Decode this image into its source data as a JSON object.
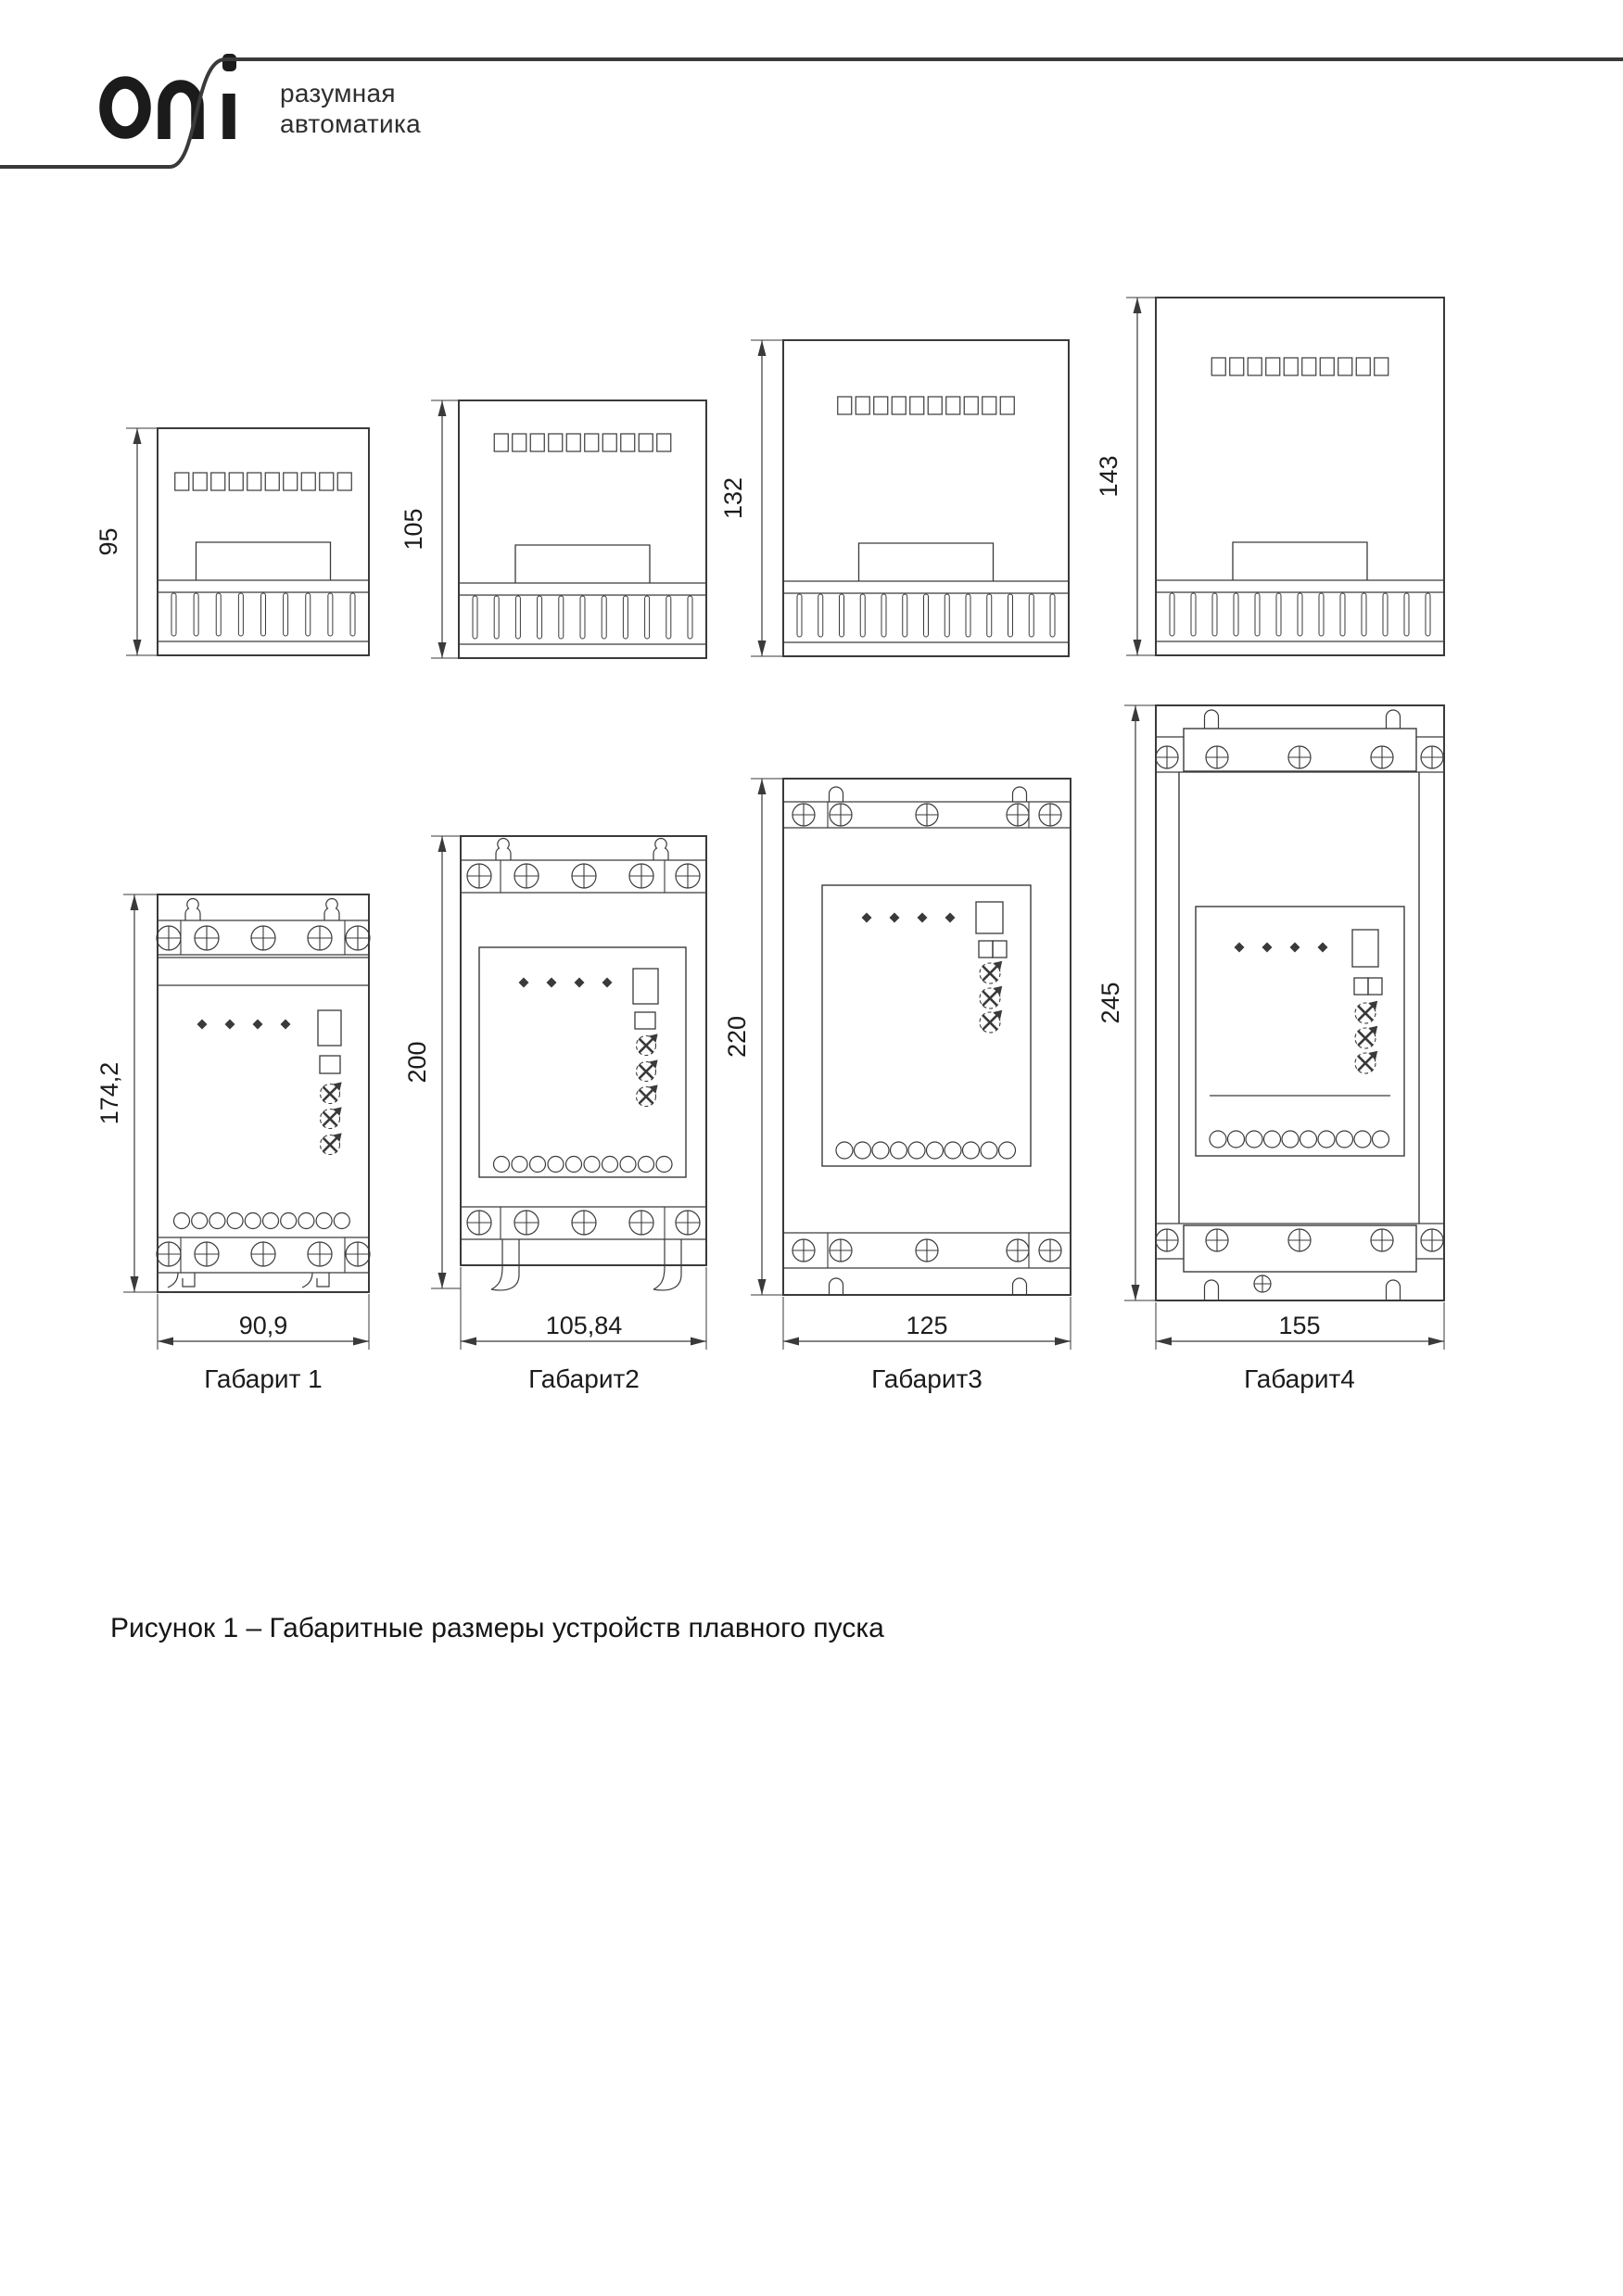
{
  "header": {
    "logo_text": "oni",
    "tagline": [
      "разумная",
      "автоматика"
    ]
  },
  "figure": {
    "caption": "Рисунок 1 – Габаритные размеры устройств плавного пуска",
    "side_views": [
      {
        "height_mm": "95"
      },
      {
        "height_mm": "105"
      },
      {
        "height_mm": "132"
      },
      {
        "height_mm": "143"
      }
    ],
    "front_views": [
      {
        "name": "Габарит 1",
        "height_mm": "174,2",
        "width_mm": "90,9"
      },
      {
        "name": "Габарит2",
        "height_mm": "200",
        "width_mm": "105,84"
      },
      {
        "name": "Габарит3",
        "height_mm": "220",
        "width_mm": "125"
      },
      {
        "name": "Габарит4",
        "height_mm": "245",
        "width_mm": "155"
      }
    ]
  },
  "colors": {
    "line": "#3a3a3a",
    "text": "#1c1c1c",
    "logo": "#1b1b1b"
  }
}
